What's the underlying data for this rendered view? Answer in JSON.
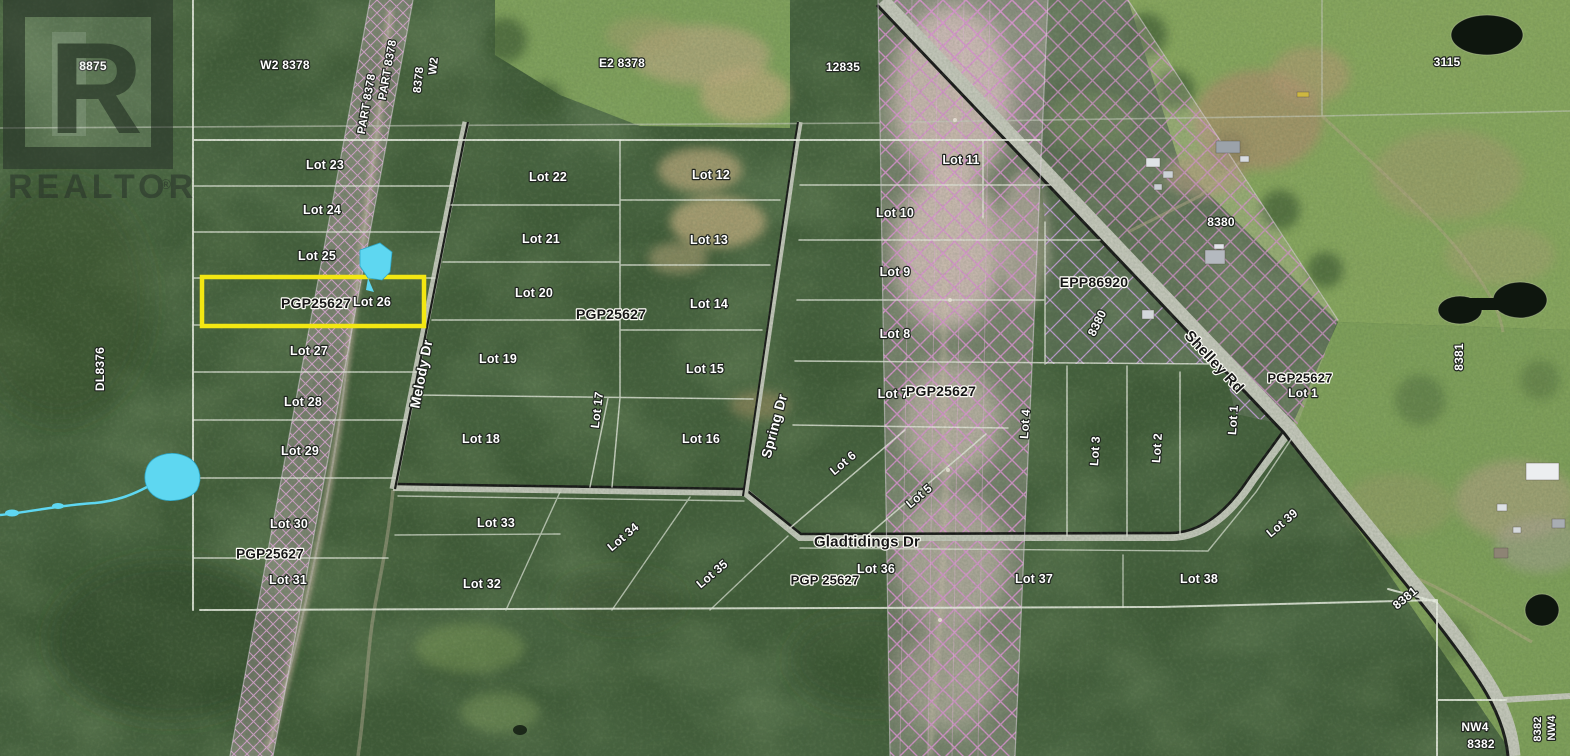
{
  "watermark": {
    "letter": "R",
    "wordmark": "REALTOR",
    "registered": "®"
  },
  "highlighted_lot": {
    "text": "Lot 26",
    "plan": "PGP25627",
    "color": "#f3e712"
  },
  "map": {
    "colors": {
      "forest": "#3f5a37",
      "field": "#87a75f",
      "highlight": "#f3e712",
      "water": "#5ed7f1",
      "hatch_pink": "#db93d2",
      "hatch_lavender": "#c9a0de",
      "road_centerline": "#161616",
      "road_fill": "#c3c7ba",
      "lot_line": "#e7ebe0"
    },
    "labels": [
      {
        "id": "num-8875",
        "t": "8875",
        "x": 93,
        "y": 66,
        "r": 0,
        "s": "w",
        "fs": 12
      },
      {
        "id": "num-w2-8378",
        "t": "W2  8378",
        "x": 285,
        "y": 65,
        "r": 0,
        "s": "w",
        "fs": 12
      },
      {
        "id": "part-8378-a",
        "t": "PART 8378",
        "x": 367,
        "y": 104,
        "r": -80,
        "s": "w",
        "fs": 11.5
      },
      {
        "id": "part-8378-b",
        "t": "PART 8378",
        "x": 388,
        "y": 70,
        "r": -80,
        "s": "w",
        "fs": 11.5
      },
      {
        "id": "num-8378-vert",
        "t": "8378",
        "x": 419,
        "y": 80,
        "r": -84,
        "s": "w",
        "fs": 11.5
      },
      {
        "id": "num-w2-vert",
        "t": "W2",
        "x": 434,
        "y": 66,
        "r": -84,
        "s": "w",
        "fs": 11.5
      },
      {
        "id": "num-e2-8378",
        "t": "E2  8378",
        "x": 622,
        "y": 63,
        "r": 0,
        "s": "w",
        "fs": 12
      },
      {
        "id": "num-12835",
        "t": "12835",
        "x": 843,
        "y": 67,
        "r": 0,
        "s": "w",
        "fs": 12
      },
      {
        "id": "num-3115",
        "t": "3115",
        "x": 1447,
        "y": 62,
        "r": 0,
        "s": "w",
        "fs": 12
      },
      {
        "id": "num-8380-h",
        "t": "8380",
        "x": 1221,
        "y": 222,
        "r": 0,
        "s": "w",
        "fs": 12
      },
      {
        "id": "lot-23",
        "t": "Lot 23",
        "x": 325,
        "y": 165,
        "r": 0,
        "s": "w",
        "fs": 12.5
      },
      {
        "id": "lot-24",
        "t": "Lot 24",
        "x": 322,
        "y": 210,
        "r": 0,
        "s": "w",
        "fs": 12.5
      },
      {
        "id": "lot-25",
        "t": "Lot 25",
        "x": 317,
        "y": 256,
        "r": 0,
        "s": "w",
        "fs": 12.5
      },
      {
        "id": "pgp25627-a",
        "t": "PGP25627",
        "x": 316,
        "y": 303,
        "r": 0,
        "s": "d",
        "fs": 14
      },
      {
        "id": "lot-26",
        "t": "Lot 26",
        "x": 372,
        "y": 302,
        "r": 0,
        "s": "w",
        "fs": 12.5
      },
      {
        "id": "lot-27",
        "t": "Lot 27",
        "x": 309,
        "y": 351,
        "r": 0,
        "s": "w",
        "fs": 12.5
      },
      {
        "id": "lot-28",
        "t": "Lot 28",
        "x": 303,
        "y": 402,
        "r": 0,
        "s": "w",
        "fs": 12.5
      },
      {
        "id": "lot-29",
        "t": "Lot 29",
        "x": 300,
        "y": 451,
        "r": 0,
        "s": "w",
        "fs": 12.5
      },
      {
        "id": "lot-30",
        "t": "Lot 30",
        "x": 289,
        "y": 524,
        "r": 0,
        "s": "w",
        "fs": 12.5
      },
      {
        "id": "pgp25627-b",
        "t": "PGP25627",
        "x": 270,
        "y": 554,
        "r": 0,
        "s": "d",
        "fs": 13.5
      },
      {
        "id": "lot-31",
        "t": "Lot 31",
        "x": 288,
        "y": 580,
        "r": 0,
        "s": "w",
        "fs": 12.5
      },
      {
        "id": "lot-22",
        "t": "Lot 22",
        "x": 548,
        "y": 177,
        "r": 0,
        "s": "w",
        "fs": 12.5
      },
      {
        "id": "lot-21",
        "t": "Lot 21",
        "x": 541,
        "y": 239,
        "r": 0,
        "s": "w",
        "fs": 12.5
      },
      {
        "id": "lot-20",
        "t": "Lot 20",
        "x": 534,
        "y": 293,
        "r": 0,
        "s": "w",
        "fs": 12.5
      },
      {
        "id": "lot-19",
        "t": "Lot 19",
        "x": 498,
        "y": 359,
        "r": 0,
        "s": "w",
        "fs": 12.5
      },
      {
        "id": "lot-18",
        "t": "Lot 18",
        "x": 481,
        "y": 439,
        "r": 0,
        "s": "w",
        "fs": 12.5
      },
      {
        "id": "lot-17",
        "t": "Lot 17",
        "x": 597,
        "y": 410,
        "r": -83,
        "s": "w",
        "fs": 12
      },
      {
        "id": "lot-16",
        "t": "Lot 16",
        "x": 701,
        "y": 439,
        "r": 0,
        "s": "w",
        "fs": 12.5
      },
      {
        "id": "lot-12",
        "t": "Lot 12",
        "x": 711,
        "y": 175,
        "r": 0,
        "s": "w",
        "fs": 12.5
      },
      {
        "id": "lot-13",
        "t": "Lot 13",
        "x": 709,
        "y": 240,
        "r": 0,
        "s": "w",
        "fs": 12.5
      },
      {
        "id": "lot-14",
        "t": "Lot 14",
        "x": 709,
        "y": 304,
        "r": 0,
        "s": "w",
        "fs": 12.5
      },
      {
        "id": "lot-15",
        "t": "Lot 15",
        "x": 705,
        "y": 369,
        "r": 0,
        "s": "w",
        "fs": 12.5
      },
      {
        "id": "pgp25627-c",
        "t": "PGP25627",
        "x": 611,
        "y": 314,
        "r": 0,
        "s": "d",
        "fs": 14
      },
      {
        "id": "lot-11",
        "t": "Lot 11",
        "x": 961,
        "y": 160,
        "r": 0,
        "s": "w",
        "fs": 12.5
      },
      {
        "id": "lot-10",
        "t": "Lot 10",
        "x": 895,
        "y": 213,
        "r": 0,
        "s": "w",
        "fs": 12.5
      },
      {
        "id": "lot-9",
        "t": "Lot 9",
        "x": 895,
        "y": 272,
        "r": 0,
        "s": "w",
        "fs": 12.5
      },
      {
        "id": "lot-8",
        "t": "Lot 8",
        "x": 895,
        "y": 334,
        "r": 0,
        "s": "w",
        "fs": 12.5
      },
      {
        "id": "lot-7",
        "t": "Lot 7",
        "x": 893,
        "y": 394,
        "r": 0,
        "s": "w",
        "fs": 12.5
      },
      {
        "id": "pgp25627-d",
        "t": "PGP25627",
        "x": 941,
        "y": 391,
        "r": 0,
        "s": "d",
        "fs": 14
      },
      {
        "id": "lot-6",
        "t": "Lot 6",
        "x": 843,
        "y": 463,
        "r": -40,
        "s": "w",
        "fs": 12
      },
      {
        "id": "lot-5",
        "t": "Lot 5",
        "x": 919,
        "y": 496,
        "r": -40,
        "s": "w",
        "fs": 12
      },
      {
        "id": "lot-4",
        "t": "Lot 4",
        "x": 1025,
        "y": 424,
        "r": -86,
        "s": "w",
        "fs": 12
      },
      {
        "id": "lot-3",
        "t": "Lot 3",
        "x": 1095,
        "y": 451,
        "r": -86,
        "s": "w",
        "fs": 12
      },
      {
        "id": "lot-2",
        "t": "Lot 2",
        "x": 1157,
        "y": 448,
        "r": -86,
        "s": "w",
        "fs": 12
      },
      {
        "id": "lot-1-west",
        "t": "Lot 1",
        "x": 1233,
        "y": 420,
        "r": -86,
        "s": "w",
        "fs": 12
      },
      {
        "id": "epp86920",
        "t": "EPP86920",
        "x": 1094,
        "y": 282,
        "r": 0,
        "s": "d",
        "fs": 14
      },
      {
        "id": "num-8380-diag",
        "t": "8380",
        "x": 1097,
        "y": 323,
        "r": -64,
        "s": "w",
        "fs": 12
      },
      {
        "id": "shelley-rd",
        "t": "Shelley Rd",
        "x": 1214,
        "y": 362,
        "r": 47,
        "s": "d",
        "fs": 15
      },
      {
        "id": "pgp25627-e",
        "t": "PGP25627",
        "x": 1300,
        "y": 378,
        "r": 0,
        "s": "d",
        "fs": 13
      },
      {
        "id": "lot-1-east",
        "t": "Lot 1",
        "x": 1303,
        "y": 393,
        "r": 0,
        "s": "w",
        "fs": 12
      },
      {
        "id": "num-8381-vert",
        "t": "8381",
        "x": 1459,
        "y": 357,
        "r": -90,
        "s": "w",
        "fs": 12
      },
      {
        "id": "melody-dr",
        "t": "Melody Dr",
        "x": 421,
        "y": 374,
        "r": -79,
        "s": "w",
        "fs": 14
      },
      {
        "id": "spring-dr",
        "t": "Spring Dr",
        "x": 774,
        "y": 426,
        "r": -75,
        "s": "w",
        "fs": 14
      },
      {
        "id": "gladtidings-dr",
        "t": "Gladtidings Dr",
        "x": 867,
        "y": 542,
        "r": 0,
        "s": "d",
        "fs": 15
      },
      {
        "id": "pgp25627-f",
        "t": "PGP 25627",
        "x": 825,
        "y": 580,
        "r": 0,
        "s": "d",
        "fs": 13
      },
      {
        "id": "lot-33",
        "t": "Lot 33",
        "x": 496,
        "y": 523,
        "r": 0,
        "s": "w",
        "fs": 12.5
      },
      {
        "id": "lot-32",
        "t": "Lot 32",
        "x": 482,
        "y": 584,
        "r": 0,
        "s": "w",
        "fs": 12.5
      },
      {
        "id": "lot-34",
        "t": "Lot 34",
        "x": 623,
        "y": 537,
        "r": -40,
        "s": "w",
        "fs": 12
      },
      {
        "id": "lot-35",
        "t": "Lot 35",
        "x": 712,
        "y": 574,
        "r": -40,
        "s": "w",
        "fs": 12
      },
      {
        "id": "lot-36",
        "t": "Lot 36",
        "x": 876,
        "y": 569,
        "r": 0,
        "s": "w",
        "fs": 12.5
      },
      {
        "id": "lot-37",
        "t": "Lot 37",
        "x": 1034,
        "y": 579,
        "r": 0,
        "s": "w",
        "fs": 12.5
      },
      {
        "id": "lot-38",
        "t": "Lot 38",
        "x": 1199,
        "y": 579,
        "r": 0,
        "s": "w",
        "fs": 12.5
      },
      {
        "id": "lot-39",
        "t": "Lot 39",
        "x": 1282,
        "y": 523,
        "r": -40,
        "s": "w",
        "fs": 12
      },
      {
        "id": "num-8381-diag",
        "t": "8381",
        "x": 1405,
        "y": 598,
        "r": -40,
        "s": "w",
        "fs": 12
      },
      {
        "id": "num-nw4",
        "t": "NW4",
        "x": 1475,
        "y": 727,
        "r": 0,
        "s": "w",
        "fs": 12
      },
      {
        "id": "num-8382",
        "t": "8382",
        "x": 1481,
        "y": 744,
        "r": 0,
        "s": "w",
        "fs": 12
      },
      {
        "id": "num-8382-vert",
        "t": "8382",
        "x": 1538,
        "y": 729,
        "r": -90,
        "s": "w",
        "fs": 11
      },
      {
        "id": "num-nw4-vert",
        "t": "NW4",
        "x": 1552,
        "y": 728,
        "r": -90,
        "s": "w",
        "fs": 11
      },
      {
        "id": "dl8376",
        "t": "DL8376",
        "x": 100,
        "y": 369,
        "r": -90,
        "s": "w",
        "fs": 12
      }
    ]
  }
}
